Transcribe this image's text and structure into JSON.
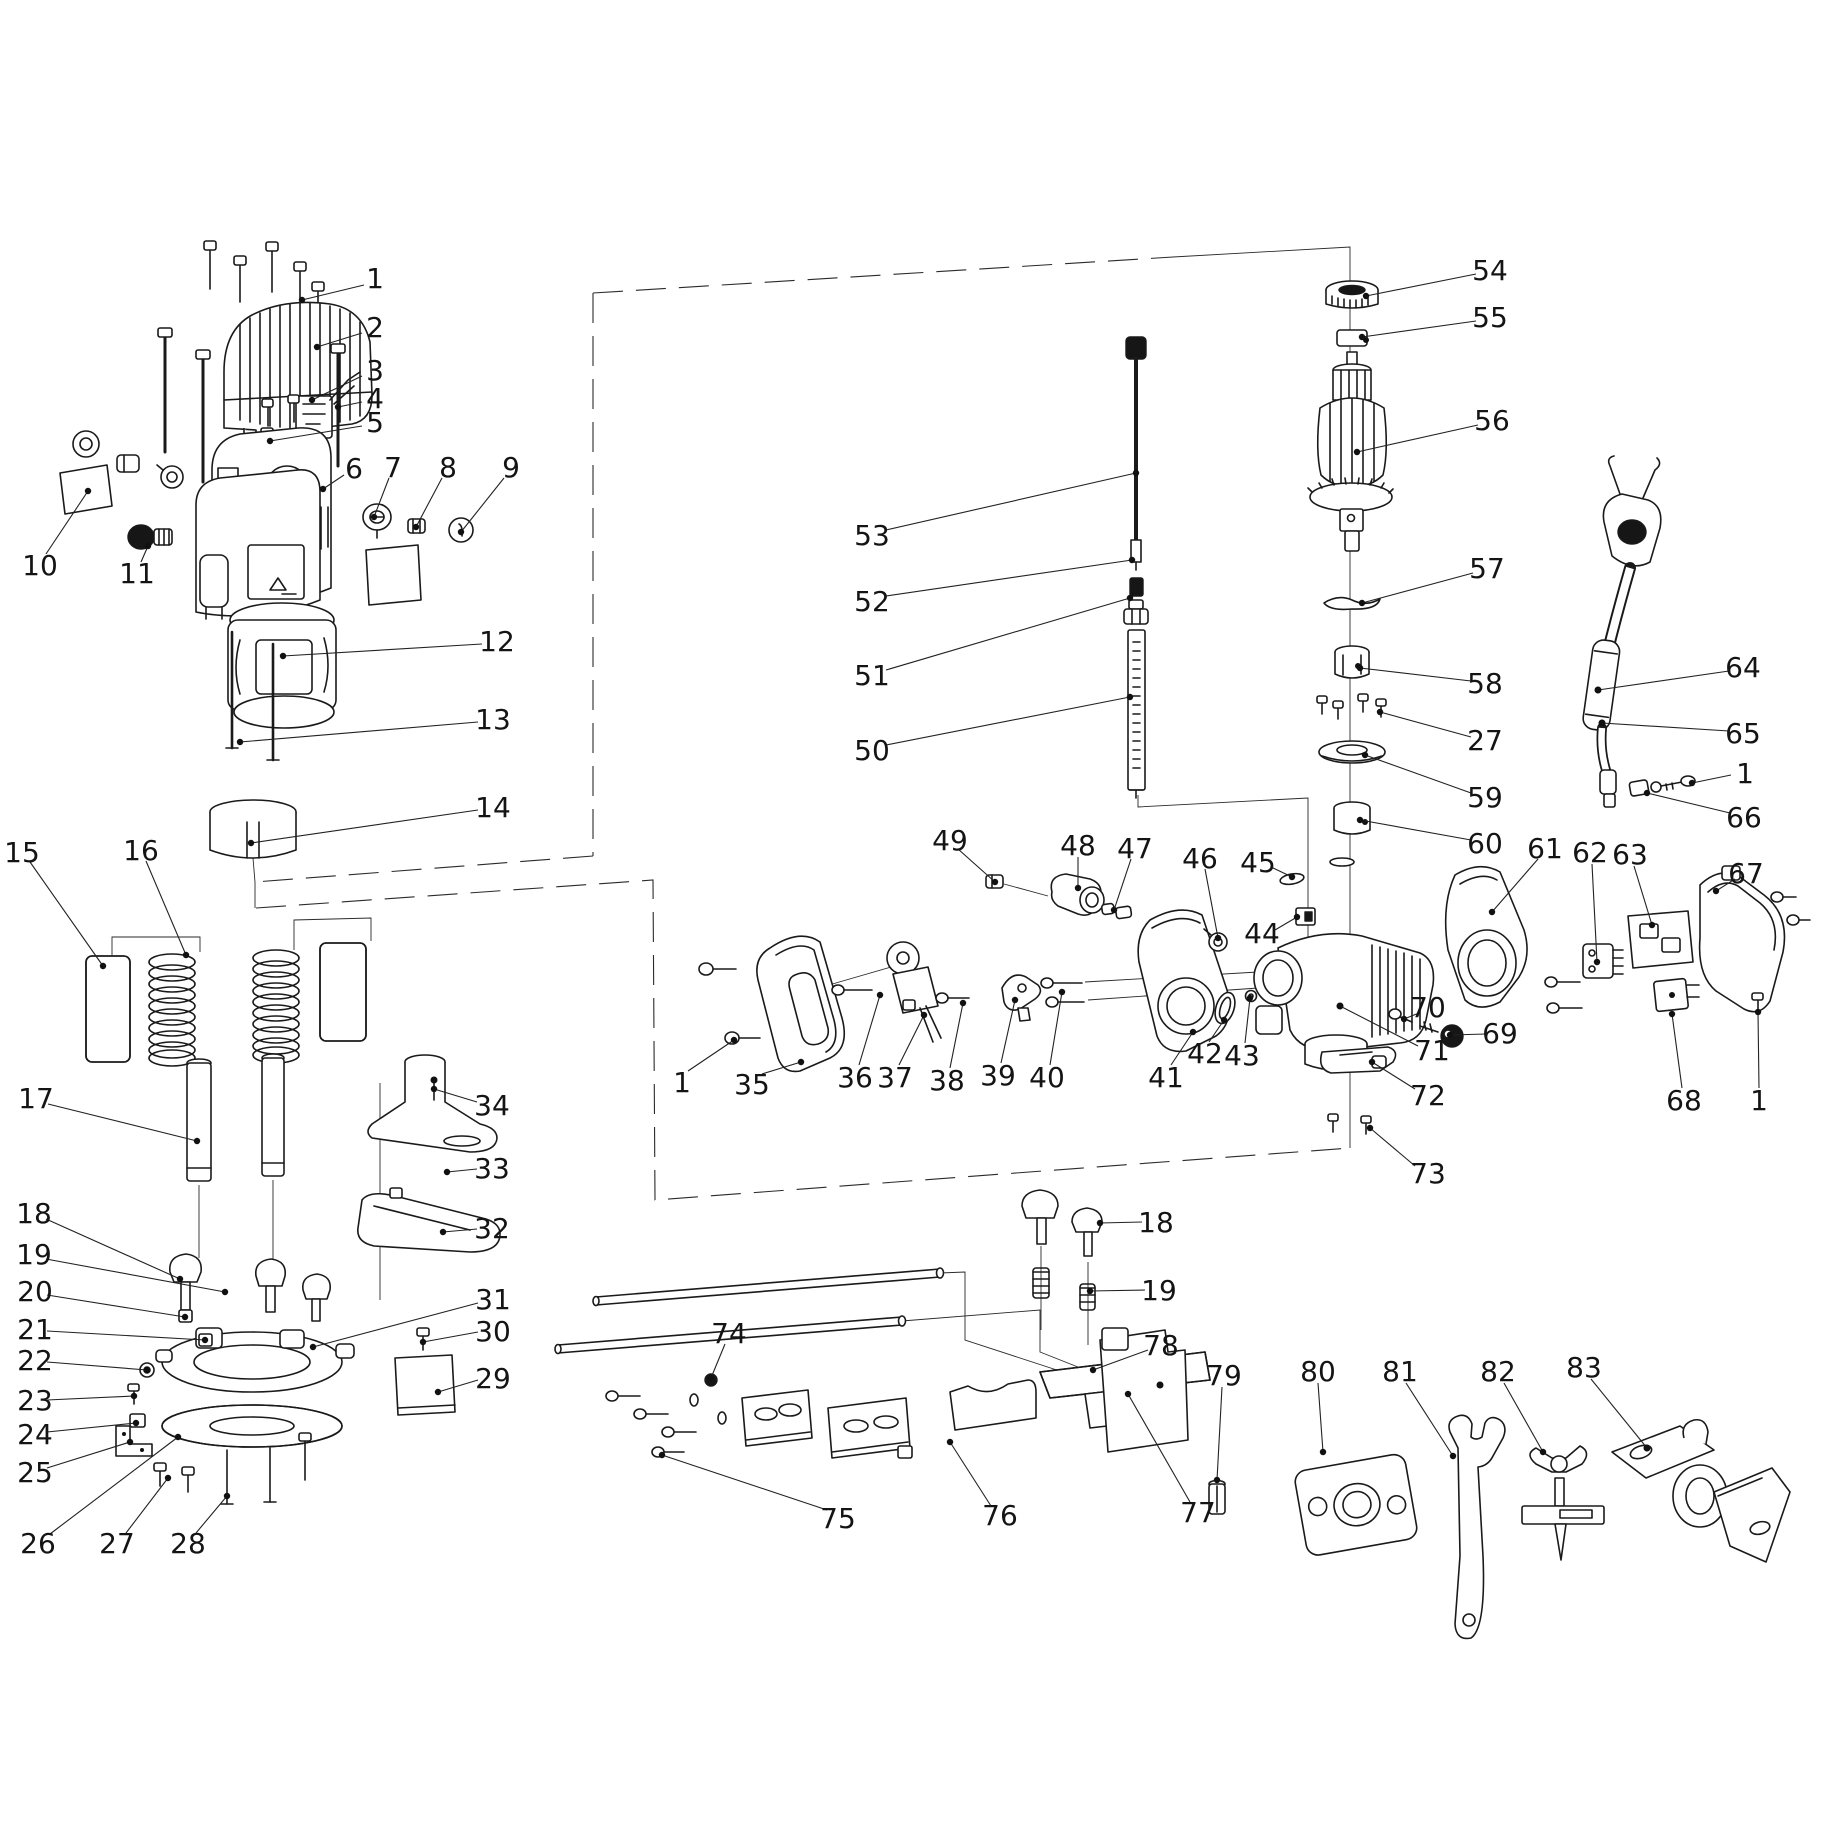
{
  "canvas": {
    "width": 1823,
    "height": 1823,
    "background": "#ffffff",
    "line_color": "#1a1a1a"
  },
  "callouts": [
    {
      "n": "1",
      "lx": 375,
      "ly": 278,
      "pts": [
        [
          364,
          285
        ],
        [
          302,
          300
        ]
      ]
    },
    {
      "n": "2",
      "lx": 375,
      "ly": 327,
      "pts": [
        [
          362,
          333
        ],
        [
          317,
          347
        ]
      ]
    },
    {
      "n": "3",
      "lx": 375,
      "ly": 370,
      "pts": [
        [
          362,
          376
        ],
        [
          312,
          400
        ]
      ]
    },
    {
      "n": "4",
      "lx": 375,
      "ly": 398,
      "pts": [
        [
          362,
          402
        ],
        [
          338,
          407
        ]
      ]
    },
    {
      "n": "5",
      "lx": 375,
      "ly": 422,
      "pts": [
        [
          362,
          426
        ],
        [
          270,
          441
        ]
      ]
    },
    {
      "n": "6",
      "lx": 354,
      "ly": 468,
      "pts": [
        [
          344,
          475
        ],
        [
          323,
          489
        ]
      ]
    },
    {
      "n": "7",
      "lx": 393,
      "ly": 467,
      "pts": [
        [
          389,
          478
        ],
        [
          374,
          517
        ]
      ]
    },
    {
      "n": "8",
      "lx": 448,
      "ly": 467,
      "pts": [
        [
          442,
          478
        ],
        [
          416,
          527
        ]
      ]
    },
    {
      "n": "9",
      "lx": 511,
      "ly": 467,
      "pts": [
        [
          504,
          478
        ],
        [
          461,
          532
        ]
      ]
    },
    {
      "n": "10",
      "lx": 40,
      "ly": 565,
      "pts": [
        [
          46,
          554
        ],
        [
          88,
          491
        ]
      ]
    },
    {
      "n": "11",
      "lx": 137,
      "ly": 573,
      "pts": [
        [
          141,
          562
        ],
        [
          148,
          546
        ]
      ]
    },
    {
      "n": "12",
      "lx": 497,
      "ly": 641,
      "pts": [
        [
          482,
          644
        ],
        [
          283,
          656
        ]
      ]
    },
    {
      "n": "13",
      "lx": 493,
      "ly": 719,
      "pts": [
        [
          478,
          722
        ],
        [
          240,
          742
        ]
      ]
    },
    {
      "n": "14",
      "lx": 493,
      "ly": 807,
      "pts": [
        [
          478,
          810
        ],
        [
          251,
          843
        ]
      ]
    },
    {
      "n": "15",
      "lx": 22,
      "ly": 852,
      "pts": [
        [
          30,
          862
        ],
        [
          103,
          966
        ]
      ]
    },
    {
      "n": "16",
      "lx": 141,
      "ly": 850,
      "pts": [
        [
          146,
          861
        ],
        [
          186,
          955
        ]
      ]
    },
    {
      "n": "17",
      "lx": 36,
      "ly": 1098,
      "pts": [
        [
          48,
          1104
        ],
        [
          197,
          1141
        ]
      ]
    },
    {
      "n": "18",
      "lx": 34,
      "ly": 1213,
      "pts": [
        [
          46,
          1219
        ],
        [
          180,
          1279
        ]
      ]
    },
    {
      "n": "19",
      "lx": 34,
      "ly": 1254,
      "pts": [
        [
          46,
          1259
        ],
        [
          225,
          1292
        ]
      ]
    },
    {
      "n": "20",
      "lx": 35,
      "ly": 1291,
      "pts": [
        [
          47,
          1295
        ],
        [
          185,
          1317
        ]
      ]
    },
    {
      "n": "21",
      "lx": 35,
      "ly": 1329,
      "pts": [
        [
          47,
          1331
        ],
        [
          205,
          1340
        ]
      ]
    },
    {
      "n": "22",
      "lx": 35,
      "ly": 1360,
      "pts": [
        [
          47,
          1362
        ],
        [
          147,
          1370
        ]
      ]
    },
    {
      "n": "23",
      "lx": 35,
      "ly": 1400,
      "pts": [
        [
          47,
          1400
        ],
        [
          134,
          1396
        ]
      ]
    },
    {
      "n": "24",
      "lx": 35,
      "ly": 1434,
      "pts": [
        [
          47,
          1432
        ],
        [
          136,
          1423
        ]
      ]
    },
    {
      "n": "25",
      "lx": 35,
      "ly": 1472,
      "pts": [
        [
          47,
          1468
        ],
        [
          130,
          1442
        ]
      ]
    },
    {
      "n": "26",
      "lx": 38,
      "ly": 1543,
      "pts": [
        [
          50,
          1534
        ],
        [
          178,
          1437
        ]
      ]
    },
    {
      "n": "27",
      "lx": 117,
      "ly": 1543,
      "pts": [
        [
          126,
          1533
        ],
        [
          168,
          1478
        ]
      ]
    },
    {
      "n": "28",
      "lx": 188,
      "ly": 1543,
      "pts": [
        [
          196,
          1533
        ],
        [
          227,
          1496
        ]
      ]
    },
    {
      "n": "29",
      "lx": 493,
      "ly": 1378,
      "pts": [
        [
          478,
          1380
        ],
        [
          438,
          1392
        ]
      ]
    },
    {
      "n": "30",
      "lx": 493,
      "ly": 1331,
      "pts": [
        [
          478,
          1332
        ],
        [
          423,
          1342
        ]
      ]
    },
    {
      "n": "31",
      "lx": 493,
      "ly": 1299,
      "pts": [
        [
          478,
          1303
        ],
        [
          313,
          1347
        ]
      ]
    },
    {
      "n": "32",
      "lx": 492,
      "ly": 1228,
      "pts": [
        [
          477,
          1229
        ],
        [
          443,
          1232
        ]
      ]
    },
    {
      "n": "33",
      "lx": 492,
      "ly": 1168,
      "pts": [
        [
          477,
          1169
        ],
        [
          447,
          1172
        ]
      ]
    },
    {
      "n": "34",
      "lx": 492,
      "ly": 1105,
      "pts": [
        [
          477,
          1102
        ],
        [
          434,
          1089
        ]
      ]
    },
    {
      "n": "35",
      "lx": 752,
      "ly": 1084,
      "pts": [
        [
          762,
          1074
        ],
        [
          801,
          1062
        ]
      ]
    },
    {
      "n": "36",
      "lx": 855,
      "ly": 1077,
      "pts": [
        [
          859,
          1065
        ],
        [
          880,
          995
        ]
      ]
    },
    {
      "n": "37",
      "lx": 895,
      "ly": 1077,
      "pts": [
        [
          899,
          1065
        ],
        [
          924,
          1015
        ]
      ]
    },
    {
      "n": "38",
      "lx": 947,
      "ly": 1080,
      "pts": [
        [
          950,
          1068
        ],
        [
          963,
          1003
        ]
      ]
    },
    {
      "n": "39",
      "lx": 998,
      "ly": 1075,
      "pts": [
        [
          1001,
          1063
        ],
        [
          1015,
          1000
        ]
      ]
    },
    {
      "n": "40",
      "lx": 1047,
      "ly": 1077,
      "pts": [
        [
          1050,
          1065
        ],
        [
          1062,
          992
        ]
      ]
    },
    {
      "n": "41",
      "lx": 1166,
      "ly": 1077,
      "pts": [
        [
          1171,
          1065
        ],
        [
          1193,
          1032
        ]
      ]
    },
    {
      "n": "42",
      "lx": 1205,
      "ly": 1053,
      "pts": [
        [
          1209,
          1042
        ],
        [
          1224,
          1020
        ]
      ]
    },
    {
      "n": "43",
      "lx": 1242,
      "ly": 1055,
      "pts": [
        [
          1245,
          1043
        ],
        [
          1250,
          998
        ]
      ]
    },
    {
      "n": "44",
      "lx": 1262,
      "ly": 933,
      "pts": [
        [
          1275,
          930
        ],
        [
          1297,
          917
        ]
      ]
    },
    {
      "n": "45",
      "lx": 1258,
      "ly": 862,
      "pts": [
        [
          1271,
          867
        ],
        [
          1292,
          877
        ]
      ]
    },
    {
      "n": "46",
      "lx": 1200,
      "ly": 858,
      "pts": [
        [
          1205,
          869
        ],
        [
          1218,
          938
        ]
      ]
    },
    {
      "n": "47",
      "lx": 1135,
      "ly": 848,
      "pts": [
        [
          1131,
          859
        ],
        [
          1114,
          910
        ]
      ]
    },
    {
      "n": "48",
      "lx": 1078,
      "ly": 845,
      "pts": [
        [
          1078,
          857
        ],
        [
          1078,
          888
        ]
      ]
    },
    {
      "n": "49",
      "lx": 950,
      "ly": 840,
      "pts": [
        [
          958,
          849
        ],
        [
          995,
          882
        ]
      ]
    },
    {
      "n": "50",
      "lx": 872,
      "ly": 750,
      "pts": [
        [
          886,
          745
        ],
        [
          1130,
          697
        ]
      ]
    },
    {
      "n": "51",
      "lx": 872,
      "ly": 675,
      "pts": [
        [
          886,
          670
        ],
        [
          1130,
          598
        ]
      ]
    },
    {
      "n": "52",
      "lx": 872,
      "ly": 601,
      "pts": [
        [
          886,
          596
        ],
        [
          1132,
          560
        ]
      ]
    },
    {
      "n": "53",
      "lx": 872,
      "ly": 535,
      "pts": [
        [
          886,
          530
        ],
        [
          1136,
          473
        ]
      ]
    },
    {
      "n": "54",
      "lx": 1490,
      "ly": 270,
      "pts": [
        [
          1476,
          274
        ],
        [
          1366,
          296
        ]
      ]
    },
    {
      "n": "55",
      "lx": 1490,
      "ly": 317,
      "pts": [
        [
          1476,
          321
        ],
        [
          1362,
          337
        ]
      ]
    },
    {
      "n": "56",
      "lx": 1492,
      "ly": 420,
      "pts": [
        [
          1478,
          425
        ],
        [
          1357,
          452
        ]
      ]
    },
    {
      "n": "57",
      "lx": 1487,
      "ly": 568,
      "pts": [
        [
          1473,
          573
        ],
        [
          1362,
          603
        ]
      ]
    },
    {
      "n": "58",
      "lx": 1485,
      "ly": 683,
      "pts": [
        [
          1471,
          681
        ],
        [
          1360,
          668
        ]
      ]
    },
    {
      "n": "27",
      "lx": 1485,
      "ly": 740,
      "pts": [
        [
          1471,
          737
        ],
        [
          1380,
          712
        ]
      ]
    },
    {
      "n": "59",
      "lx": 1485,
      "ly": 797,
      "pts": [
        [
          1471,
          793
        ],
        [
          1365,
          755
        ]
      ]
    },
    {
      "n": "60",
      "lx": 1485,
      "ly": 843,
      "pts": [
        [
          1471,
          840
        ],
        [
          1360,
          820
        ]
      ]
    },
    {
      "n": "61",
      "lx": 1545,
      "ly": 848,
      "pts": [
        [
          1538,
          859
        ],
        [
          1492,
          912
        ]
      ]
    },
    {
      "n": "62",
      "lx": 1590,
      "ly": 852,
      "pts": [
        [
          1592,
          864
        ],
        [
          1597,
          962
        ]
      ]
    },
    {
      "n": "63",
      "lx": 1630,
      "ly": 854,
      "pts": [
        [
          1634,
          866
        ],
        [
          1652,
          925
        ]
      ]
    },
    {
      "n": "64",
      "lx": 1743,
      "ly": 667,
      "pts": [
        [
          1729,
          671
        ],
        [
          1598,
          690
        ]
      ]
    },
    {
      "n": "65",
      "lx": 1743,
      "ly": 733,
      "pts": [
        [
          1729,
          731
        ],
        [
          1602,
          723
        ]
      ]
    },
    {
      "n": "1",
      "lx": 1745,
      "ly": 773,
      "pts": [
        [
          1731,
          775
        ],
        [
          1692,
          783
        ]
      ]
    },
    {
      "n": "66",
      "lx": 1744,
      "ly": 817,
      "pts": [
        [
          1730,
          813
        ],
        [
          1647,
          793
        ]
      ]
    },
    {
      "n": "67",
      "lx": 1746,
      "ly": 873,
      "pts": [
        [
          1735,
          879
        ],
        [
          1716,
          891
        ]
      ]
    },
    {
      "n": "68",
      "lx": 1684,
      "ly": 1100,
      "pts": [
        [
          1682,
          1088
        ],
        [
          1672,
          1014
        ]
      ]
    },
    {
      "n": "1",
      "lx": 1759,
      "ly": 1100,
      "pts": [
        [
          1759,
          1088
        ],
        [
          1758,
          1012
        ]
      ]
    },
    {
      "n": "69",
      "lx": 1500,
      "ly": 1033,
      "pts": [
        [
          1486,
          1034
        ],
        [
          1450,
          1035
        ]
      ]
    },
    {
      "n": "70",
      "lx": 1428,
      "ly": 1007,
      "pts": [
        [
          1419,
          1013
        ],
        [
          1404,
          1019
        ]
      ]
    },
    {
      "n": "71",
      "lx": 1432,
      "ly": 1050,
      "pts": [
        [
          1418,
          1046
        ],
        [
          1340,
          1006
        ]
      ]
    },
    {
      "n": "72",
      "lx": 1428,
      "ly": 1095,
      "pts": [
        [
          1415,
          1089
        ],
        [
          1372,
          1062
        ]
      ]
    },
    {
      "n": "73",
      "lx": 1428,
      "ly": 1173,
      "pts": [
        [
          1415,
          1166
        ],
        [
          1370,
          1128
        ]
      ]
    },
    {
      "n": "1",
      "lx": 682,
      "ly": 1082,
      "pts": [
        [
          688,
          1071
        ],
        [
          734,
          1040
        ]
      ]
    },
    {
      "n": "74",
      "lx": 729,
      "ly": 1333,
      "pts": [
        [
          725,
          1344
        ],
        [
          711,
          1378
        ]
      ]
    },
    {
      "n": "75",
      "lx": 838,
      "ly": 1518,
      "pts": [
        [
          827,
          1510
        ],
        [
          662,
          1455
        ]
      ]
    },
    {
      "n": "76",
      "lx": 1000,
      "ly": 1515,
      "pts": [
        [
          991,
          1506
        ],
        [
          950,
          1442
        ]
      ]
    },
    {
      "n": "77",
      "lx": 1198,
      "ly": 1512,
      "pts": [
        [
          1190,
          1502
        ],
        [
          1128,
          1394
        ]
      ]
    },
    {
      "n": "18",
      "lx": 1156,
      "ly": 1222,
      "pts": [
        [
          1142,
          1222
        ],
        [
          1100,
          1223
        ]
      ]
    },
    {
      "n": "19",
      "lx": 1159,
      "ly": 1290,
      "pts": [
        [
          1145,
          1290
        ],
        [
          1090,
          1291
        ]
      ]
    },
    {
      "n": "78",
      "lx": 1161,
      "ly": 1345,
      "pts": [
        [
          1148,
          1350
        ],
        [
          1093,
          1370
        ]
      ]
    },
    {
      "n": "79",
      "lx": 1224,
      "ly": 1375,
      "pts": [
        [
          1222,
          1387
        ],
        [
          1217,
          1480
        ]
      ]
    },
    {
      "n": "80",
      "lx": 1318,
      "ly": 1371,
      "pts": [
        [
          1318,
          1383
        ],
        [
          1323,
          1452
        ]
      ]
    },
    {
      "n": "81",
      "lx": 1400,
      "ly": 1371,
      "pts": [
        [
          1406,
          1383
        ],
        [
          1453,
          1456
        ]
      ]
    },
    {
      "n": "82",
      "lx": 1498,
      "ly": 1371,
      "pts": [
        [
          1504,
          1383
        ],
        [
          1543,
          1452
        ]
      ]
    },
    {
      "n": "83",
      "lx": 1584,
      "ly": 1367,
      "pts": [
        [
          1591,
          1379
        ],
        [
          1647,
          1448
        ]
      ]
    }
  ]
}
